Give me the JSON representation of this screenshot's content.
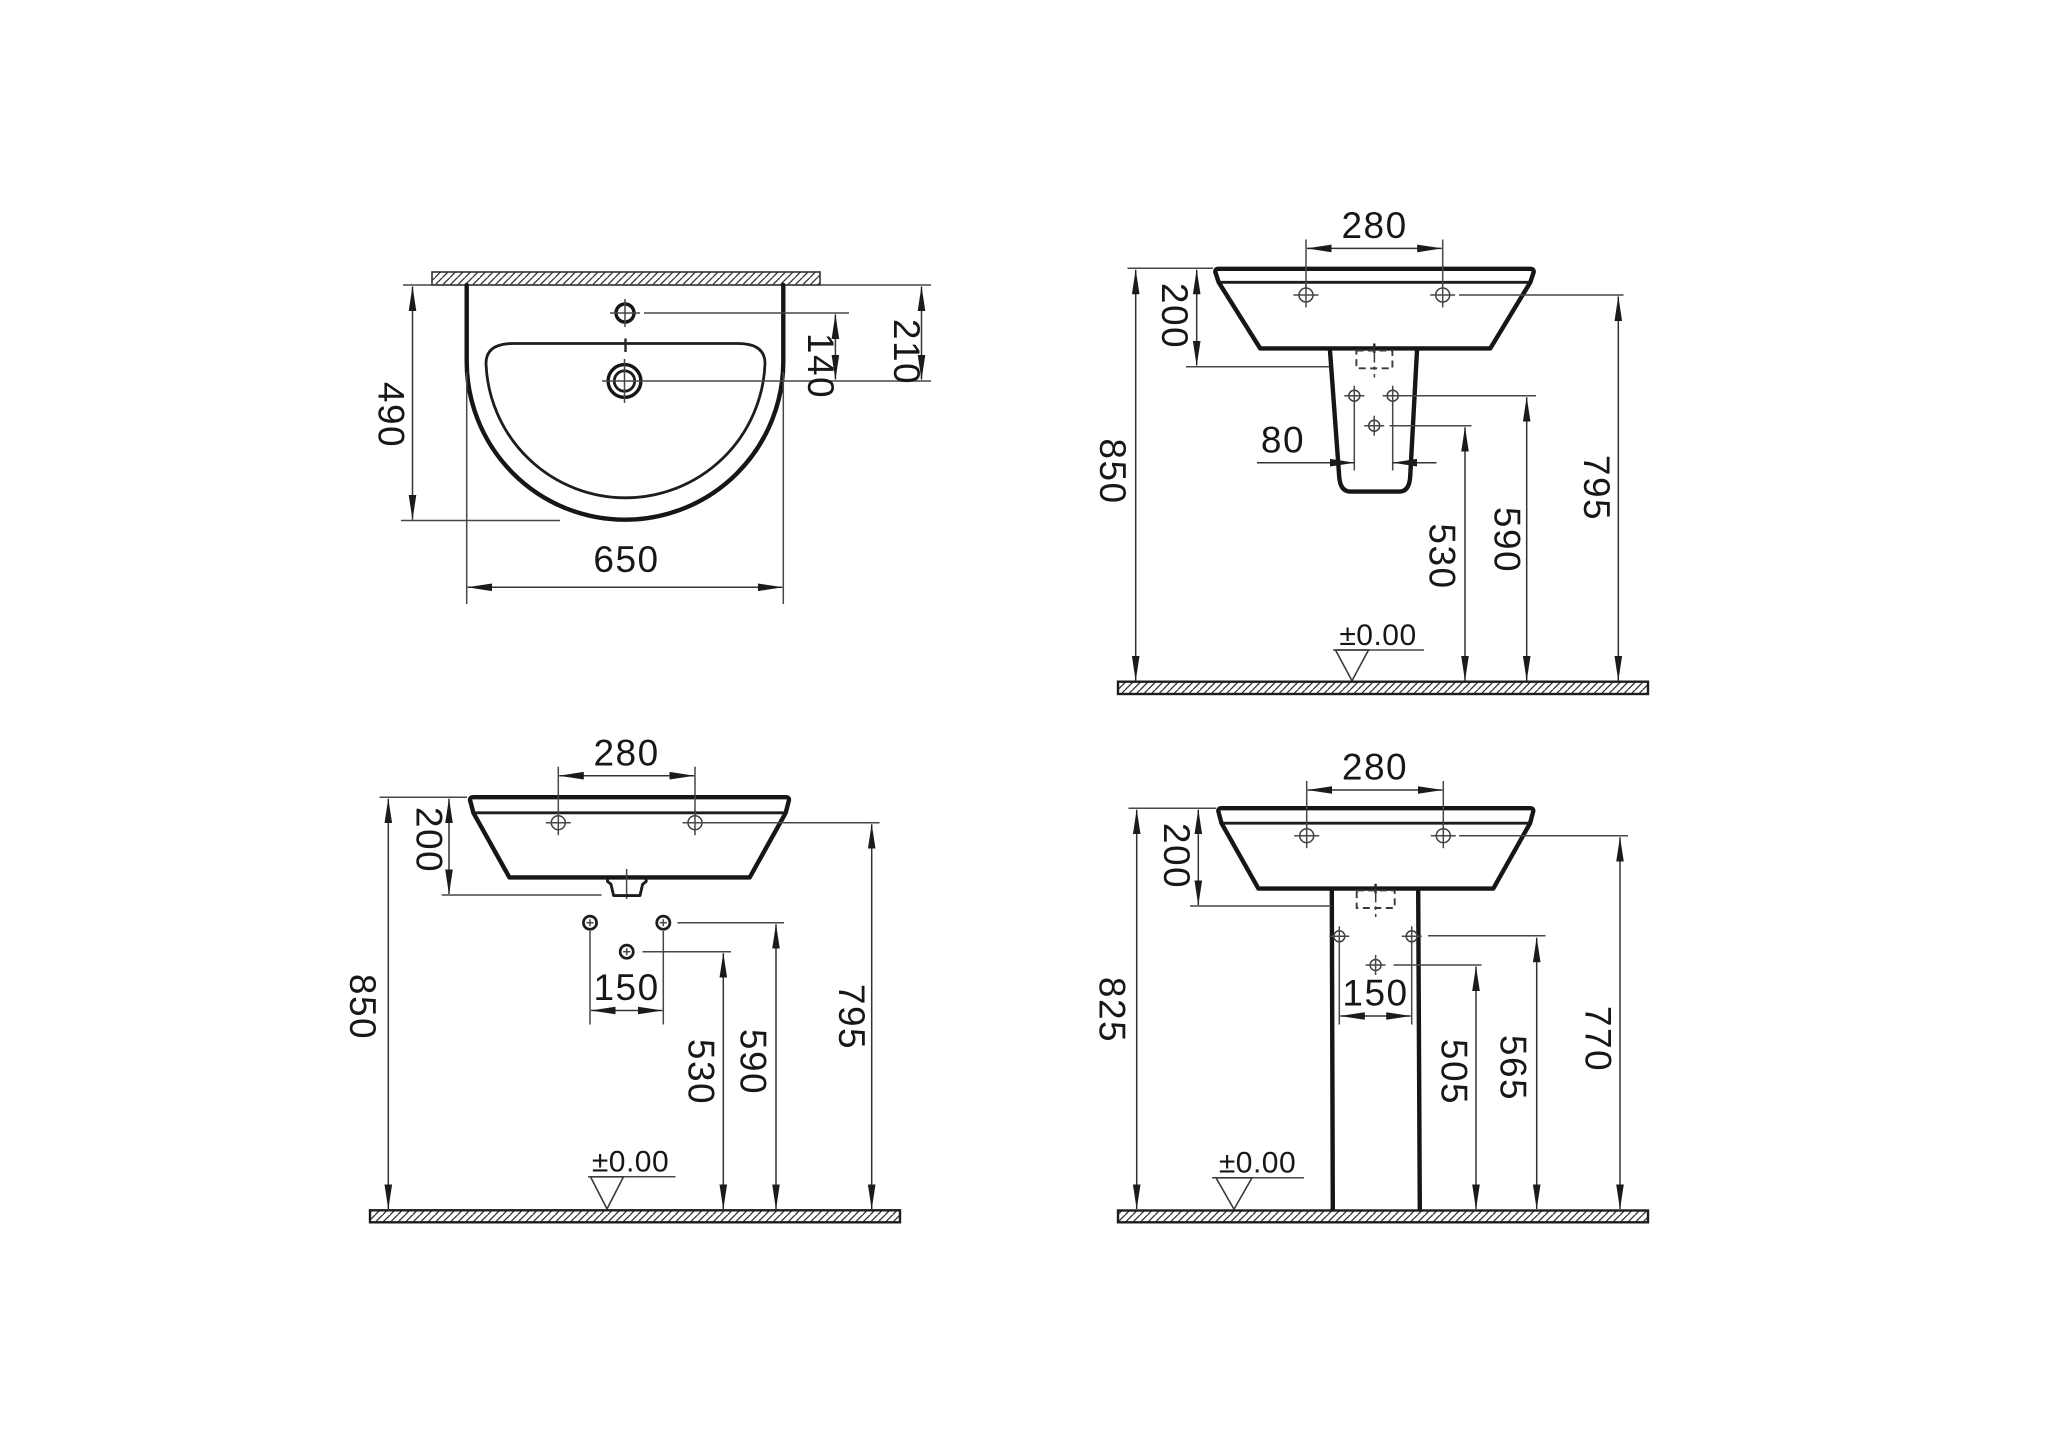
{
  "drawing": {
    "type": "washbasin-installation-dimensions",
    "unit_note": "dimensions in mm as printed",
    "views": {
      "plan": {
        "width": "650",
        "depth": "490",
        "tap_hole_offset": "140",
        "drain_offset": "210"
      },
      "semi": {
        "hole_spacing": "280",
        "basin_height": "200",
        "pedestal_hole_spacing": "80",
        "total_height": "850",
        "drain_hole_height": "530",
        "pedestal_fix_height": "590",
        "rim_fix_height": "795",
        "datum": "±0.00"
      },
      "wall": {
        "hole_spacing": "280",
        "basin_height": "200",
        "fix_spacing": "150",
        "total_height": "850",
        "drain_fix_height": "530",
        "wall_fix_height": "590",
        "rim_fix_height": "795",
        "datum": "±0.00"
      },
      "full": {
        "hole_spacing": "280",
        "basin_height": "200",
        "fix_spacing": "150",
        "total_height": "825",
        "ped_fix_height_low": "505",
        "ped_fix_height_high": "565",
        "rim_fix_height": "770",
        "datum": "±0.00"
      }
    }
  }
}
